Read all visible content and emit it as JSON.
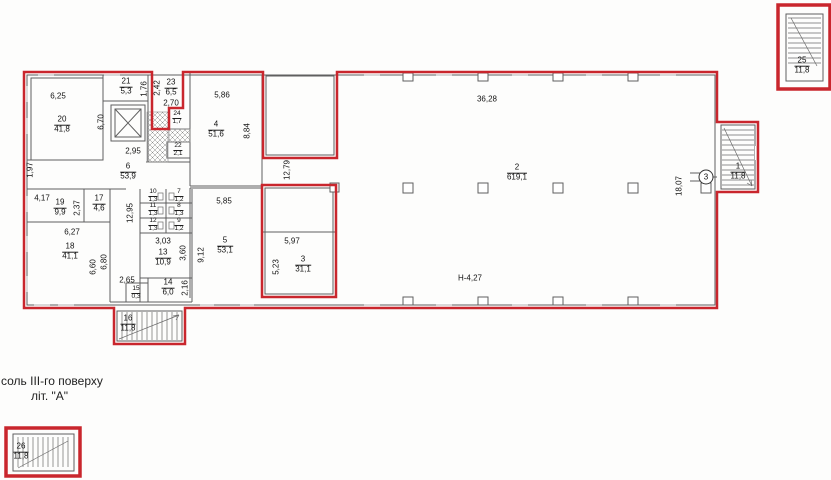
{
  "meta": {
    "caption_line1": "соль  ІІІ-го поверху",
    "caption_line2": "літ. \"А\""
  },
  "colors": {
    "boundary_red": "#c9262d",
    "wall_gray": "#5f5f5f",
    "hatch_gray": "#8a8a8a",
    "text_dark": "#111111"
  },
  "axis_markers": [
    {
      "label": "3",
      "x": 706,
      "y": 177
    }
  ],
  "room_labels": [
    {
      "n": "1",
      "a": "11,8",
      "x": 738,
      "y": 172,
      "small": false
    },
    {
      "n": "2",
      "a": "619,1",
      "x": 517,
      "y": 173,
      "small": false
    },
    {
      "n": "3",
      "a": "31,1",
      "x": 303,
      "y": 265,
      "small": false
    },
    {
      "n": "4",
      "a": "51,6",
      "x": 216,
      "y": 130,
      "small": false
    },
    {
      "n": "5",
      "a": "53,1",
      "x": 225,
      "y": 246,
      "small": false
    },
    {
      "n": "6",
      "a": "53,9",
      "x": 128,
      "y": 172,
      "small": false
    },
    {
      "n": "7",
      "a": "1,2",
      "x": 179,
      "y": 196,
      "small": true
    },
    {
      "n": "8",
      "a": "1,3",
      "x": 179,
      "y": 210,
      "small": true
    },
    {
      "n": "9",
      "a": "1,2",
      "x": 179,
      "y": 225,
      "small": true
    },
    {
      "n": "10",
      "a": "1,3",
      "x": 153,
      "y": 196,
      "small": true
    },
    {
      "n": "11",
      "a": "1,3",
      "x": 153,
      "y": 210,
      "small": true
    },
    {
      "n": "12",
      "a": "1,3",
      "x": 153,
      "y": 225,
      "small": true
    },
    {
      "n": "13",
      "a": "10,9",
      "x": 163,
      "y": 258,
      "small": false
    },
    {
      "n": "14",
      "a": "6,0",
      "x": 168,
      "y": 288,
      "small": false
    },
    {
      "n": "15",
      "a": "0,3",
      "x": 136,
      "y": 293,
      "small": true
    },
    {
      "n": "16",
      "a": "11,8",
      "x": 128,
      "y": 324,
      "small": false
    },
    {
      "n": "17",
      "a": "4,6",
      "x": 99,
      "y": 204,
      "small": false
    },
    {
      "n": "18",
      "a": "41,1",
      "x": 70,
      "y": 252,
      "small": false
    },
    {
      "n": "19",
      "a": "9,9",
      "x": 60,
      "y": 208,
      "small": false
    },
    {
      "n": "20",
      "a": "41,8",
      "x": 62,
      "y": 125,
      "small": false
    },
    {
      "n": "21",
      "a": "5,3",
      "x": 126,
      "y": 87,
      "small": false
    },
    {
      "n": "22",
      "a": "2,1",
      "x": 178,
      "y": 150,
      "small": true
    },
    {
      "n": "23",
      "a": "6,5",
      "x": 171,
      "y": 88,
      "small": false
    },
    {
      "n": "24",
      "a": "1,7",
      "x": 177,
      "y": 118,
      "small": true
    },
    {
      "n": "25",
      "a": "11,8",
      "x": 802,
      "y": 66,
      "small": false
    },
    {
      "n": "26",
      "a": "11,8",
      "x": 21,
      "y": 452,
      "small": false
    }
  ],
  "dim_labels": [
    {
      "t": "6,25",
      "x": 58,
      "y": 96,
      "v": false
    },
    {
      "t": "6,70",
      "x": 101,
      "y": 122,
      "v": true
    },
    {
      "t": "1,76",
      "x": 144,
      "y": 89,
      "v": true
    },
    {
      "t": "2,42",
      "x": 157,
      "y": 88,
      "v": true
    },
    {
      "t": "2,70",
      "x": 171,
      "y": 103,
      "v": false
    },
    {
      "t": "2,95",
      "x": 133,
      "y": 151,
      "v": false
    },
    {
      "t": "1,97",
      "x": 30,
      "y": 170,
      "v": true
    },
    {
      "t": "4,17",
      "x": 42,
      "y": 198,
      "v": false
    },
    {
      "t": "2,37",
      "x": 77,
      "y": 208,
      "v": true
    },
    {
      "t": "12,95",
      "x": 130,
      "y": 213,
      "v": true
    },
    {
      "t": "6,27",
      "x": 72,
      "y": 232,
      "v": false
    },
    {
      "t": "6,60",
      "x": 93,
      "y": 267,
      "v": true
    },
    {
      "t": "6,80",
      "x": 104,
      "y": 262,
      "v": true
    },
    {
      "t": "3,03",
      "x": 163,
      "y": 241,
      "v": false
    },
    {
      "t": "3,60",
      "x": 183,
      "y": 253,
      "v": true
    },
    {
      "t": "2,65",
      "x": 127,
      "y": 280,
      "v": false
    },
    {
      "t": "2,16",
      "x": 185,
      "y": 288,
      "v": true
    },
    {
      "t": "5,86",
      "x": 222,
      "y": 95,
      "v": false
    },
    {
      "t": "8,84",
      "x": 247,
      "y": 131,
      "v": true
    },
    {
      "t": "12,79",
      "x": 287,
      "y": 170,
      "v": true
    },
    {
      "t": "5,85",
      "x": 224,
      "y": 201,
      "v": false
    },
    {
      "t": "9,12",
      "x": 201,
      "y": 255,
      "v": true
    },
    {
      "t": "5,97",
      "x": 292,
      "y": 241,
      "v": false
    },
    {
      "t": "5,23",
      "x": 276,
      "y": 267,
      "v": true
    },
    {
      "t": "36,28",
      "x": 487,
      "y": 99,
      "v": false
    },
    {
      "t": "18,07",
      "x": 679,
      "y": 186,
      "v": true
    },
    {
      "t": "Н-4,27",
      "x": 470,
      "y": 278,
      "v": false
    }
  ]
}
